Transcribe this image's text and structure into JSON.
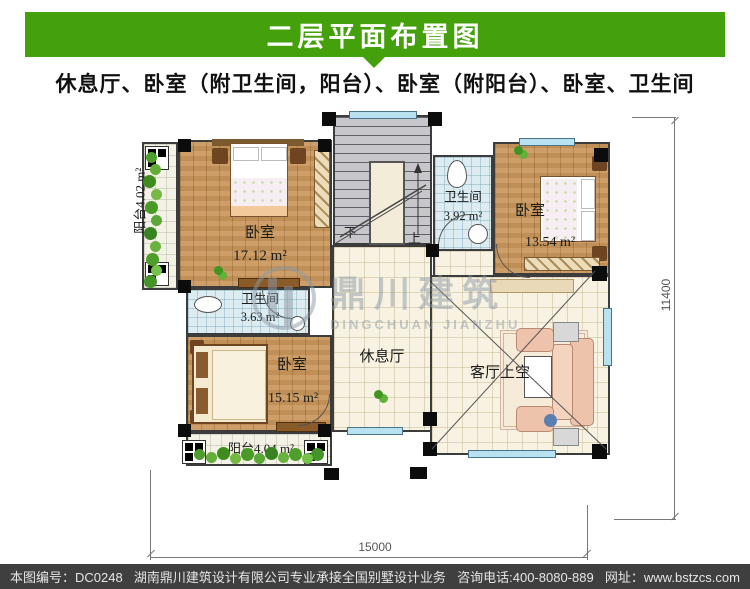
{
  "banner": {
    "title": "二层平面布置图"
  },
  "subtitle": "休息厅、卧室（附卫生间，阳台）、卧室（附阳台）、卧室、卫生间",
  "colors": {
    "banner_green": "#44a00b",
    "footer_bg": "#3f3f3f",
    "window_blue": "#b9e2f0"
  },
  "plan": {
    "rooms": {
      "bedroom_tl": {
        "name": "卧室",
        "area": "17.12 m²"
      },
      "balcony_left": {
        "label": "阳台4.02 m²"
      },
      "bath_top": {
        "name": "卫生间",
        "area": "3.92 m²"
      },
      "bedroom_tr": {
        "name": "卧室",
        "area": "13.54 m²"
      },
      "bath_mid": {
        "name": "卫生间",
        "area": "3.63 m²"
      },
      "bedroom_bl": {
        "name": "卧室",
        "area": "15.15 m²"
      },
      "hall": {
        "name": "休息厅"
      },
      "living": {
        "name": "客厅上空"
      },
      "balcony_bottom": {
        "label": "阳台4.04 m²"
      }
    },
    "stairs": {
      "down": "下",
      "up": "上"
    },
    "dimensions": {
      "bottom": "15000",
      "right": "11400"
    }
  },
  "watermark": {
    "cn": "鼎川建筑",
    "en": "DINGCHUAN JIANZHU"
  },
  "footer": {
    "sheet_no": "本图编号：DC0248",
    "company": "湖南鼎川建筑设计有限公司专业承接全国别墅设计业务",
    "phone": "咨询电话:400-8080-889",
    "website": "网址：www.bstzcs.com"
  }
}
